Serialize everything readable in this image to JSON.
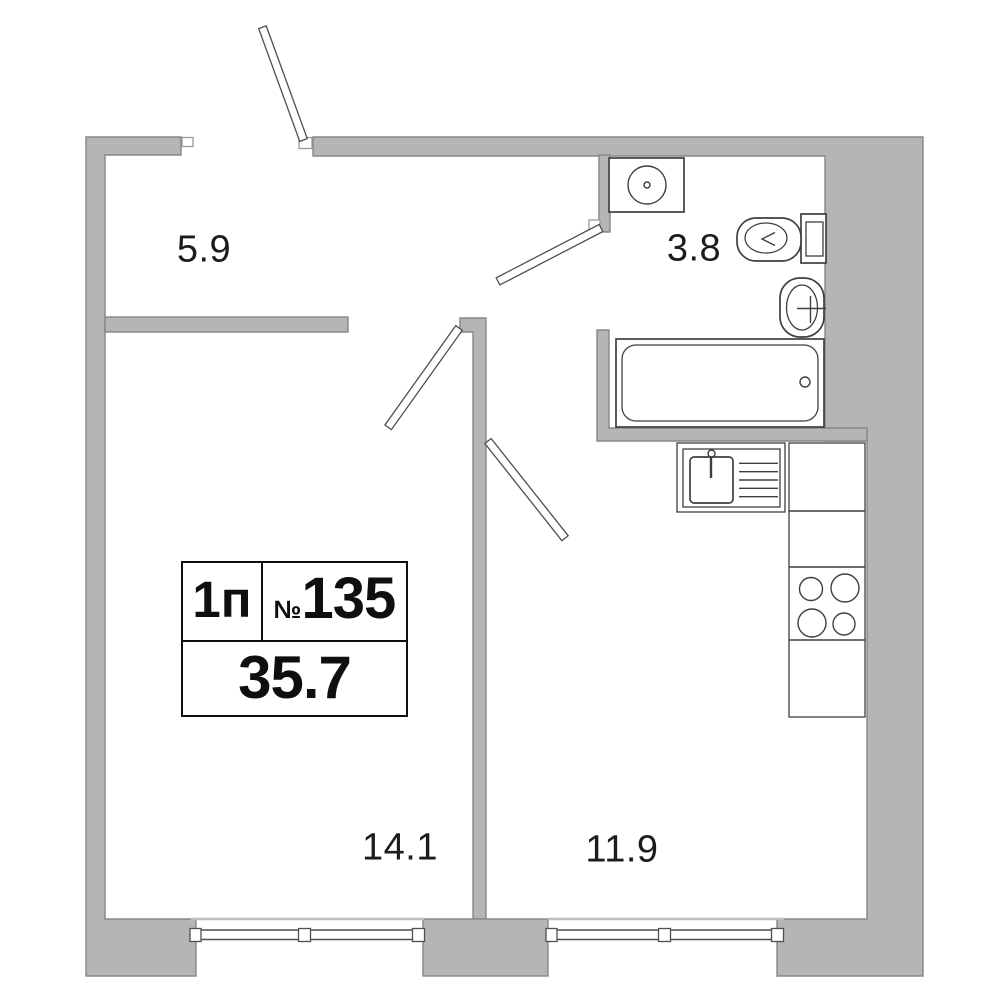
{
  "plan": {
    "unit": {
      "type": "1п",
      "number_symbol": "№",
      "number": "135",
      "area": "35.7"
    },
    "rooms": [
      {
        "name": "hallway",
        "area": "5.9"
      },
      {
        "name": "bathroom",
        "area": "3.8"
      },
      {
        "name": "living-room",
        "area": "14.1"
      },
      {
        "name": "kitchen",
        "area": "11.9"
      }
    ],
    "fixtures": [
      "washing-machine",
      "toilet",
      "washbasin",
      "bathtub",
      "kitchen-sink",
      "counter",
      "stove-cooktop"
    ],
    "openings": [
      "entrance-door",
      "bathroom-door",
      "living-room-door",
      "kitchen-door",
      "living-room-window",
      "kitchen-window"
    ],
    "colors": {
      "wall_fill": "#b5b5b5",
      "wall_stroke": "#878787",
      "line": "#3f3f3f",
      "sill": "#bdbdbd",
      "text": "#1c1c1c",
      "box_border": "#0f0f0f",
      "background": "#ffffff"
    }
  }
}
